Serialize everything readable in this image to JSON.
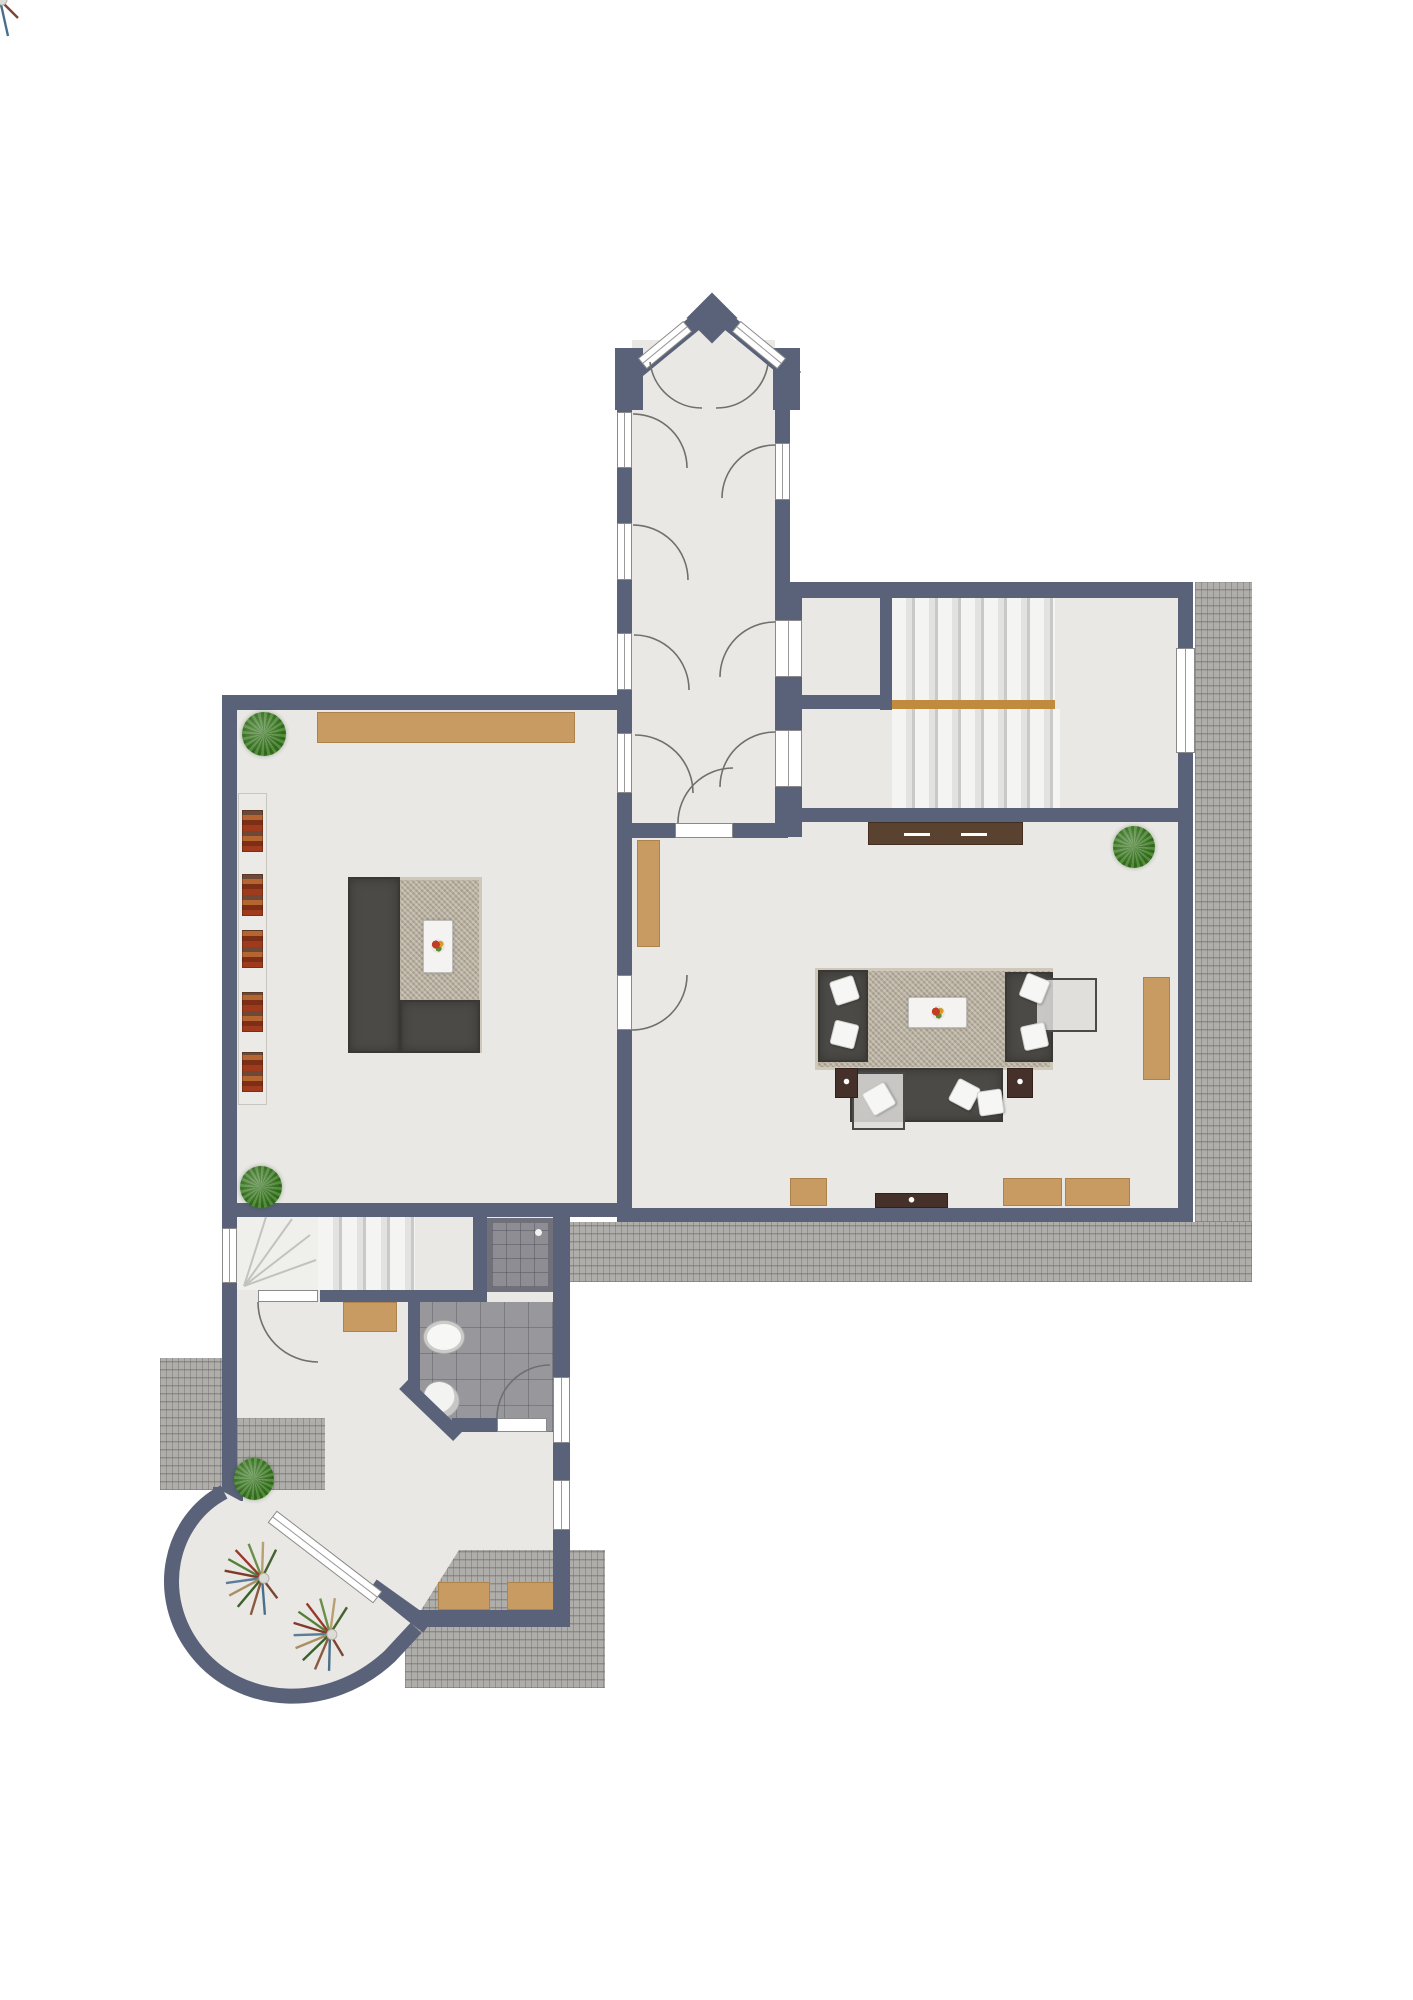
{
  "palette": {
    "wall": "#596279",
    "floor": "#e9e8e4",
    "floor_alt": "#efefec",
    "terrace_base": "#b0aeab",
    "tile": "#97979c",
    "shower": "#8d8d93",
    "shower_frame": "#70707a",
    "stair": "#f2f2f0",
    "stair_line": "#c9c9c7",
    "landing_wood": "#c08b3e",
    "wood": "#c79b61",
    "wood_dark": "#5a4231",
    "wood_dark2": "#46302a",
    "shelf": "#eceae6",
    "rug": "#b6ad9d",
    "sofa": "#4c4a46",
    "pillow": "#f6f6f4",
    "win_line": "#9a9a9a",
    "arc": "#6f6f6f",
    "plant_a": "#4f8f38",
    "plant_b": "#35661f"
  },
  "elements": [
    {
      "n": "floor-corridor",
      "t": "floor",
      "x": 632,
      "y": 340,
      "w": 143,
      "h": 483
    },
    {
      "n": "floor-left-room",
      "t": "floor",
      "x": 237,
      "y": 710,
      "w": 380,
      "h": 493
    },
    {
      "n": "floor-right-room",
      "t": "floor",
      "x": 632,
      "y": 822,
      "w": 546,
      "h": 386
    },
    {
      "n": "floor-stair-hall",
      "t": "floor",
      "x": 790,
      "y": 598,
      "w": 388,
      "h": 210
    },
    {
      "n": "floor-lower-hall",
      "t": "floor",
      "x": 237,
      "y": 1203,
      "w": 316,
      "h": 407
    },
    {
      "n": "floor-shower-nook",
      "t": "floor",
      "x": 473,
      "y": 1217,
      "w": 97,
      "h": 85
    },
    {
      "n": "floor-winder-fan",
      "t": "floor-alt",
      "x": 237,
      "y": 1217,
      "w": 83,
      "h": 73
    },
    {
      "n": "floor-bathroom",
      "t": "tile bath",
      "x": 408,
      "y": 1302,
      "w": 145,
      "h": 130
    },
    {
      "n": "terrace-right",
      "t": "terrace",
      "x": 1195,
      "y": 582,
      "w": 57,
      "h": 640
    },
    {
      "n": "terrace-bottom",
      "t": "terrace",
      "x": 567,
      "y": 1222,
      "w": 685,
      "h": 60
    },
    {
      "n": "terrace-entry-left",
      "t": "terrace",
      "x": 160,
      "y": 1358,
      "w": 62,
      "h": 132
    },
    {
      "n": "terrace-entry-inner",
      "t": "terrace",
      "x": 237,
      "y": 1418,
      "w": 88,
      "h": 72
    },
    {
      "n": "terrace-southwest",
      "t": "terrace terrace-sw",
      "x": 405,
      "y": 1550,
      "w": 200,
      "h": 138
    },
    {
      "n": "stairs-upper-flight",
      "t": "stairs",
      "x": 892,
      "y": 598,
      "w": 163,
      "h": 102
    },
    {
      "n": "stairs-landing-edge",
      "t": "wood-strip",
      "x": 892,
      "y": 700,
      "w": 163,
      "h": 9
    },
    {
      "n": "stairs-lower-flight",
      "t": "stairs",
      "x": 892,
      "y": 709,
      "w": 168,
      "h": 99
    },
    {
      "n": "stairs-winder-straight",
      "t": "stairs-sm",
      "x": 318,
      "y": 1217,
      "w": 97,
      "h": 73
    },
    {
      "n": "shower",
      "t": "shower",
      "x": 487,
      "y": 1218,
      "w": 66,
      "h": 74
    },
    {
      "n": "sideboard-left-room",
      "t": "wood",
      "x": 317,
      "y": 712,
      "w": 258,
      "h": 31
    },
    {
      "n": "doormat-entry",
      "t": "wood",
      "x": 343,
      "y": 1302,
      "w": 54,
      "h": 30
    },
    {
      "n": "cabinet-right-room-west",
      "t": "wood",
      "x": 637,
      "y": 840,
      "w": 23,
      "h": 107
    },
    {
      "n": "cabinet-right-room-east",
      "t": "wood",
      "x": 1143,
      "y": 977,
      "w": 27,
      "h": 103
    },
    {
      "n": "bench-south-1",
      "t": "wood",
      "x": 790,
      "y": 1178,
      "w": 37,
      "h": 28
    },
    {
      "n": "bench-south-2",
      "t": "wood",
      "x": 1003,
      "y": 1178,
      "w": 59,
      "h": 28
    },
    {
      "n": "bench-south-3",
      "t": "wood",
      "x": 1065,
      "y": 1178,
      "w": 65,
      "h": 28
    },
    {
      "n": "bench-sw-terrace-1",
      "t": "wood",
      "x": 438,
      "y": 1582,
      "w": 52,
      "h": 28
    },
    {
      "n": "bench-sw-terrace-2",
      "t": "wood",
      "x": 507,
      "y": 1582,
      "w": 48,
      "h": 28
    },
    {
      "n": "sideboard-stair-wall",
      "t": "darkwood",
      "x": 868,
      "y": 822,
      "w": 155,
      "h": 23
    },
    {
      "n": "tv-console",
      "t": "darkwood2",
      "x": 875,
      "y": 1193,
      "w": 73,
      "h": 15
    },
    {
      "n": "bookshelf",
      "t": "shelf",
      "x": 238,
      "y": 793,
      "w": 29,
      "h": 312
    },
    {
      "n": "books-1",
      "t": "books",
      "x": 242,
      "y": 810,
      "w": 21,
      "h": 42
    },
    {
      "n": "books-2",
      "t": "books",
      "x": 242,
      "y": 874,
      "w": 21,
      "h": 42
    },
    {
      "n": "books-3",
      "t": "books",
      "x": 242,
      "y": 930,
      "w": 21,
      "h": 38
    },
    {
      "n": "books-4",
      "t": "books",
      "x": 242,
      "y": 992,
      "w": 21,
      "h": 40
    },
    {
      "n": "books-5",
      "t": "books",
      "x": 242,
      "y": 1052,
      "w": 21,
      "h": 40
    },
    {
      "n": "rug-left-room",
      "t": "rug",
      "x": 348,
      "y": 877,
      "w": 134,
      "h": 176
    },
    {
      "n": "sofa-left-room-side",
      "t": "sofa",
      "x": 348,
      "y": 877,
      "w": 52,
      "h": 176
    },
    {
      "n": "sofa-left-room-bottom",
      "t": "sofa",
      "x": 400,
      "y": 1000,
      "w": 80,
      "h": 53
    },
    {
      "n": "coffee-table-left",
      "t": "wtable",
      "x": 423,
      "y": 920,
      "w": 30,
      "h": 53
    },
    {
      "n": "fruit-bowl-left",
      "t": "fruit",
      "x": 431,
      "y": 939,
      "w": 14,
      "h": 14
    },
    {
      "n": "rug-right-room",
      "t": "rug",
      "x": 815,
      "y": 968,
      "w": 238,
      "h": 102
    },
    {
      "n": "armchairs-west",
      "t": "sofa",
      "x": 818,
      "y": 970,
      "w": 50,
      "h": 92
    },
    {
      "n": "armchairs-east",
      "t": "sofa",
      "x": 1005,
      "y": 972,
      "w": 48,
      "h": 90
    },
    {
      "n": "sofa-south",
      "t": "sofa",
      "x": 850,
      "y": 1068,
      "w": 153,
      "h": 54
    },
    {
      "n": "glass-table-east",
      "t": "glass",
      "x": 1035,
      "y": 978,
      "w": 62,
      "h": 54
    },
    {
      "n": "glass-table-south",
      "t": "glass",
      "x": 852,
      "y": 1072,
      "w": 53,
      "h": 58
    },
    {
      "n": "coffee-table-right",
      "t": "wtable",
      "x": 908,
      "y": 997,
      "w": 59,
      "h": 31
    },
    {
      "n": "fruit-bowl-right",
      "t": "fruit",
      "x": 931,
      "y": 1006,
      "w": 14,
      "h": 14
    },
    {
      "n": "side-table-west",
      "t": "darkwood2",
      "x": 835,
      "y": 1068,
      "w": 23,
      "h": 30
    },
    {
      "n": "side-table-east",
      "t": "darkwood2",
      "x": 1007,
      "y": 1068,
      "w": 26,
      "h": 30
    },
    {
      "n": "pillow-1",
      "t": "pillow",
      "x": 832,
      "y": 978,
      "w": 25,
      "h": 25,
      "r": -18
    },
    {
      "n": "pillow-2",
      "t": "pillow",
      "x": 832,
      "y": 1022,
      "w": 25,
      "h": 25,
      "r": 14
    },
    {
      "n": "pillow-3",
      "t": "pillow",
      "x": 1022,
      "y": 976,
      "w": 25,
      "h": 25,
      "r": 22
    },
    {
      "n": "pillow-4",
      "t": "pillow",
      "x": 1022,
      "y": 1024,
      "w": 25,
      "h": 25,
      "r": -12
    },
    {
      "n": "pillow-5",
      "t": "pillow",
      "x": 952,
      "y": 1082,
      "w": 25,
      "h": 25,
      "r": 28
    },
    {
      "n": "pillow-6",
      "t": "pillow",
      "x": 978,
      "y": 1090,
      "w": 25,
      "h": 25,
      "r": -8
    },
    {
      "n": "pillow-7",
      "t": "pillow",
      "x": 866,
      "y": 1086,
      "w": 26,
      "h": 26,
      "r": -30
    },
    {
      "n": "sink",
      "t": "sink",
      "x": 423,
      "y": 1320,
      "w": 42,
      "h": 34
    },
    {
      "n": "toilet",
      "t": "toilet",
      "x": 424,
      "y": 1380,
      "w": 34,
      "h": 38,
      "r": -45
    },
    {
      "n": "wall-outer-west",
      "t": "wall",
      "x": 222,
      "y": 695,
      "w": 15,
      "h": 795
    },
    {
      "n": "wall-left-room-north",
      "t": "wall",
      "x": 222,
      "y": 695,
      "w": 410,
      "h": 15
    },
    {
      "n": "wall-corridor-west",
      "t": "wall",
      "x": 617,
      "y": 350,
      "w": 15,
      "h": 487
    },
    {
      "n": "wall-corridor-east-upper",
      "t": "wall",
      "x": 775,
      "y": 350,
      "w": 15,
      "h": 248
    },
    {
      "n": "wall-corridor-east-lower",
      "t": "wall",
      "x": 775,
      "y": 598,
      "w": 27,
      "h": 239
    },
    {
      "n": "wall-stair-hall-north",
      "t": "wall",
      "x": 775,
      "y": 582,
      "w": 418,
      "h": 16
    },
    {
      "n": "wall-outer-east",
      "t": "wall",
      "x": 1178,
      "y": 582,
      "w": 15,
      "h": 640
    },
    {
      "n": "wall-small-room-east",
      "t": "wall",
      "x": 880,
      "y": 598,
      "w": 12,
      "h": 112
    },
    {
      "n": "wall-small-room-south",
      "t": "wall",
      "x": 788,
      "y": 695,
      "w": 104,
      "h": 14
    },
    {
      "n": "wall-stair-hall-south",
      "t": "wall",
      "x": 788,
      "y": 808,
      "w": 405,
      "h": 14
    },
    {
      "n": "wall-corridor-south-w",
      "t": "wall",
      "x": 617,
      "y": 823,
      "w": 58,
      "h": 15
    },
    {
      "n": "wall-corridor-south-e",
      "t": "wall",
      "x": 733,
      "y": 823,
      "w": 55,
      "h": 15
    },
    {
      "n": "wall-rooms-divider",
      "t": "wall",
      "x": 617,
      "y": 837,
      "w": 15,
      "h": 371
    },
    {
      "n": "wall-left-room-south",
      "t": "wall",
      "x": 222,
      "y": 1203,
      "w": 410,
      "h": 14
    },
    {
      "n": "wall-right-room-south",
      "t": "wall",
      "x": 617,
      "y": 1208,
      "w": 576,
      "h": 14
    },
    {
      "n": "wall-stairs-south",
      "t": "wall",
      "x": 320,
      "y": 1290,
      "w": 167,
      "h": 12
    },
    {
      "n": "wall-bath-west",
      "t": "wall",
      "x": 408,
      "y": 1290,
      "w": 12,
      "h": 100
    },
    {
      "n": "wall-bath-south",
      "t": "wall",
      "x": 452,
      "y": 1418,
      "w": 45,
      "h": 14
    },
    {
      "n": "wall-hall-east",
      "t": "wall",
      "x": 553,
      "y": 1208,
      "w": 17,
      "h": 419
    },
    {
      "n": "wall-shower-west",
      "t": "wall",
      "x": 473,
      "y": 1217,
      "w": 14,
      "h": 85
    },
    {
      "n": "wall-hall-south",
      "t": "wall",
      "x": 417,
      "y": 1610,
      "w": 140,
      "h": 17
    },
    {
      "n": "wall-balcony-stub",
      "t": "wall",
      "x": 213,
      "y": 1487,
      "w": 30,
      "h": 14
    },
    {
      "n": "window-corridor-west-1",
      "t": "win win-v",
      "x": 617,
      "y": 412,
      "w": 15,
      "h": 56
    },
    {
      "n": "window-corridor-west-2",
      "t": "win win-v",
      "x": 617,
      "y": 523,
      "w": 15,
      "h": 57
    },
    {
      "n": "window-corridor-west-3",
      "t": "win win-v",
      "x": 617,
      "y": 633,
      "w": 15,
      "h": 57
    },
    {
      "n": "window-corridor-west-4",
      "t": "win win-v",
      "x": 617,
      "y": 733,
      "w": 15,
      "h": 60
    },
    {
      "n": "window-corridor-east-1",
      "t": "win win-v",
      "x": 775,
      "y": 443,
      "w": 15,
      "h": 57
    },
    {
      "n": "window-corridor-east-2",
      "t": "win win-v",
      "x": 775,
      "y": 620,
      "w": 27,
      "h": 57
    },
    {
      "n": "window-corridor-east-3",
      "t": "win win-v",
      "x": 775,
      "y": 730,
      "w": 27,
      "h": 57
    },
    {
      "n": "window-stair-hall-east",
      "t": "win win-v",
      "x": 1176,
      "y": 648,
      "w": 19,
      "h": 105
    },
    {
      "n": "window-hall-west",
      "t": "win win-v",
      "x": 222,
      "y": 1228,
      "w": 15,
      "h": 55
    },
    {
      "n": "window-hall-east-1",
      "t": "win win-v",
      "x": 553,
      "y": 1377,
      "w": 17,
      "h": 66
    },
    {
      "n": "window-hall-east-2",
      "t": "win win-v",
      "x": 553,
      "y": 1480,
      "w": 17,
      "h": 50
    },
    {
      "n": "door-corridor-south",
      "t": "door",
      "x": 675,
      "y": 823,
      "w": 58,
      "h": 15
    },
    {
      "n": "door-rooms-divider",
      "t": "door",
      "x": 617,
      "y": 975,
      "w": 15,
      "h": 55
    },
    {
      "n": "door-entry",
      "t": "door",
      "x": 258,
      "y": 1290,
      "w": 60,
      "h": 12
    },
    {
      "n": "door-bathroom",
      "t": "door",
      "x": 497,
      "y": 1418,
      "w": 50,
      "h": 14
    },
    {
      "n": "plant-left-room-north",
      "t": "plant",
      "x": 242,
      "y": 712,
      "w": 44,
      "h": 44
    },
    {
      "n": "plant-left-room-south",
      "t": "plant",
      "x": 240,
      "y": 1166,
      "w": 42,
      "h": 42
    },
    {
      "n": "plant-right-room",
      "t": "plant",
      "x": 1113,
      "y": 826,
      "w": 42,
      "h": 42
    },
    {
      "n": "plant-entry",
      "t": "plant",
      "x": 234,
      "y": 1458,
      "w": 40,
      "h": 42
    }
  ]
}
